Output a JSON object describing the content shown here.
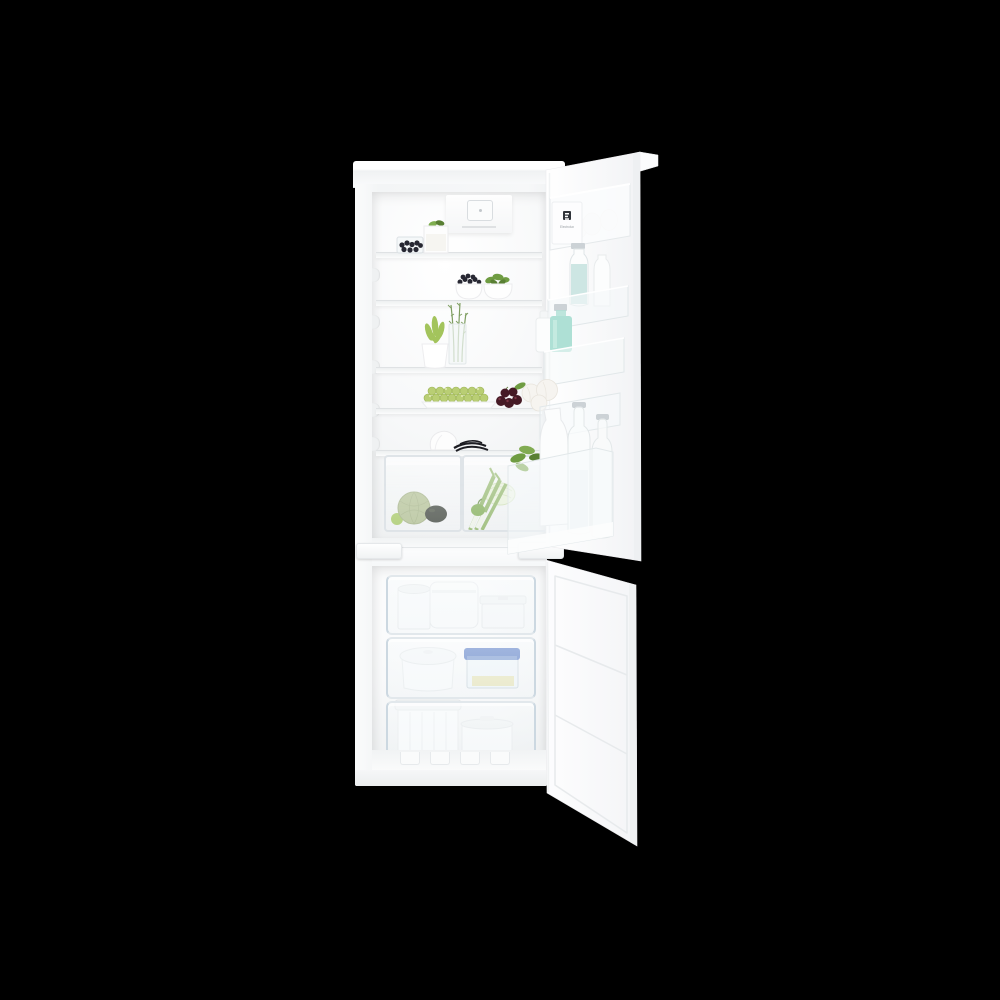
{
  "photo": {
    "subject": "Built-in fridge-freezer with both doors open, fully stocked with food",
    "background_color": "#000000"
  },
  "brand": {
    "door_logo": "Electrolux"
  },
  "sections": {
    "fridge_compartment": "Refrigerator compartment with glass shelves",
    "fridge_door": "Open refrigerator door with storage bins",
    "freezer_compartment": "Freezer compartment with three transparent drawers",
    "freezer_door": "Open freezer door with recessed inner panels"
  },
  "colors": {
    "bg": "#000000",
    "white": "#ffffff",
    "shell": "#f4f5f6",
    "line": "#e2e5e7",
    "interior-lo": "#edeff0",
    "blueberry": "#272732",
    "basil": "#6f9c42",
    "basil-dark": "#597f33",
    "mint": "#7fae4f",
    "rosemary": "#7f9e62",
    "bean": "#a3c45c",
    "grape": "#b9ce74",
    "grape-line": "#9ab253",
    "cherry": "#451a25",
    "cherry-hi": "#7b3545",
    "melon": "#a9b884",
    "melon-net": "#93a36f",
    "lime": "#9cc24f",
    "avocado": "#242a20",
    "cabbage": "#e7f0d6",
    "cabbage-line": "#c8dcaa",
    "leek": "#81ab52",
    "pepper": "#6fa23c",
    "garlic": "#f6f4f0",
    "egg": "#f7f5f2",
    "milk": "#cde6e3",
    "teal": "#aee0d5",
    "cap": "#ccd2d6",
    "blue-lid": "#5377c4",
    "pasta": "#e9e6bb",
    "drawer-edge": "#ccd8e1",
    "glass": "#eef3f5",
    "logo-dark": "#30343a",
    "logo-text": "#989ea3"
  },
  "items": {
    "fridge": [
      "temperature control unit",
      "glass box of blueberries",
      "yogurt glass with mint leaves",
      "bowl of blueberries",
      "bowl of basil",
      "white pot with green plant",
      "rosemary sprigs in a glass",
      "plate of green grapes",
      "dark cherries with leaf",
      "linen bag",
      "vanilla pods",
      "crisper drawer with melon, lime and avocado",
      "crisper drawer with cabbage, leeks and pepper"
    ],
    "door": [
      "egg bin with brand badge",
      "glass bottle of milk",
      "small milk bottle",
      "mint green bottle",
      "white bottle",
      "garlic bulbs",
      "white water carafe",
      "glass water bottles",
      "fresh herb leaves"
    ],
    "freezer": [
      "round white tub",
      "large white container",
      "lidded white box",
      "round white casserole",
      "clear box with blue lid",
      "tall white container",
      "white freezer tub"
    ]
  }
}
